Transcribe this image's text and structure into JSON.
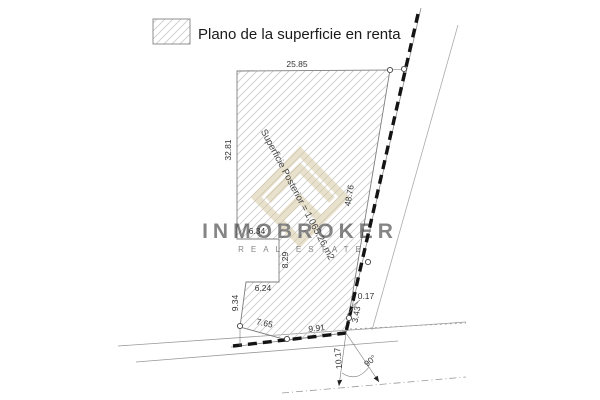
{
  "legend": {
    "label": "Plano de la superficie en renta",
    "swatch": "diagonal-hatch"
  },
  "parcel": {
    "area_label": "Superficie Posterior = 1,065.26 m2",
    "dims": {
      "top": "25.85",
      "left": "32.81",
      "step_top": "6.34",
      "step_right": "8.29",
      "step_mid": "6.24",
      "step_left": "9.34",
      "bottom_left": "7.65",
      "bottom_right": "9.91",
      "right": "48.76",
      "gap": "0.17",
      "edge_small": "3.43",
      "frontage_offset": "10.17",
      "angle": "90°"
    }
  },
  "watermark": {
    "title": "INMOBROKER",
    "subtitle": "REAL ESTATE"
  },
  "colors": {
    "boundary_dashed": "#141414",
    "parcel_line": "#7d7d7d",
    "hatch": "#c9c9c9",
    "street_line": "#9a9a9a",
    "watermark": "#d7c9a4",
    "text": "#222222"
  }
}
